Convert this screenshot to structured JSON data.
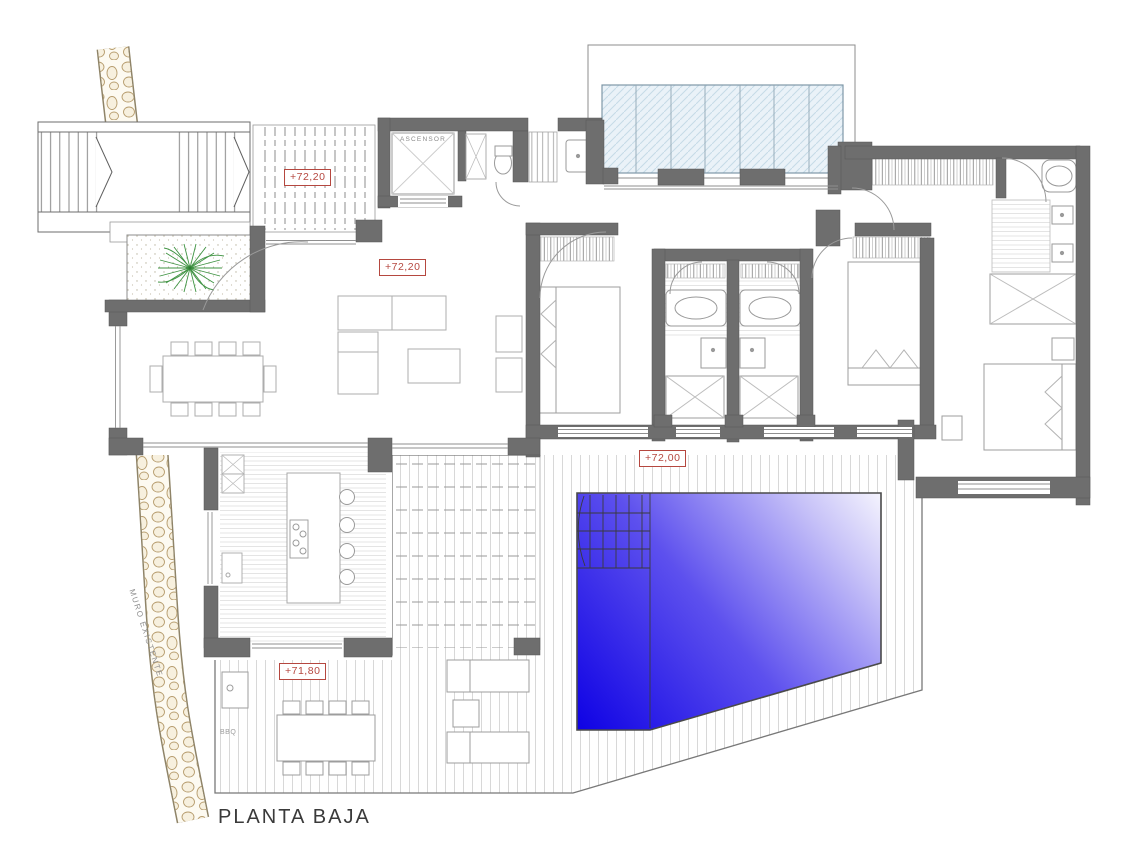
{
  "title": "PLANTA BAJA",
  "plan": {
    "levels": {
      "upper_terrace": "+72,20",
      "living": "+72,20",
      "pool_deck": "+72,00",
      "bbq_terrace": "+71,80"
    },
    "rooms": {
      "elevator": "ASCENSOR",
      "bbq_area": "BBQ"
    },
    "annotations": {
      "existing_wall": "MURO EXISTENTE"
    }
  },
  "colors": {
    "wall_gray": "#6e6e6e",
    "label_red": "#b5473f",
    "pool_deep_blue": "#0d00e4",
    "pool_light": "#ffffff",
    "glass_blue": "#eaf2f8",
    "plant_green": "#3f9342",
    "pebble_tan": "#b79d6e",
    "deck_line": "#d4d4d4"
  }
}
